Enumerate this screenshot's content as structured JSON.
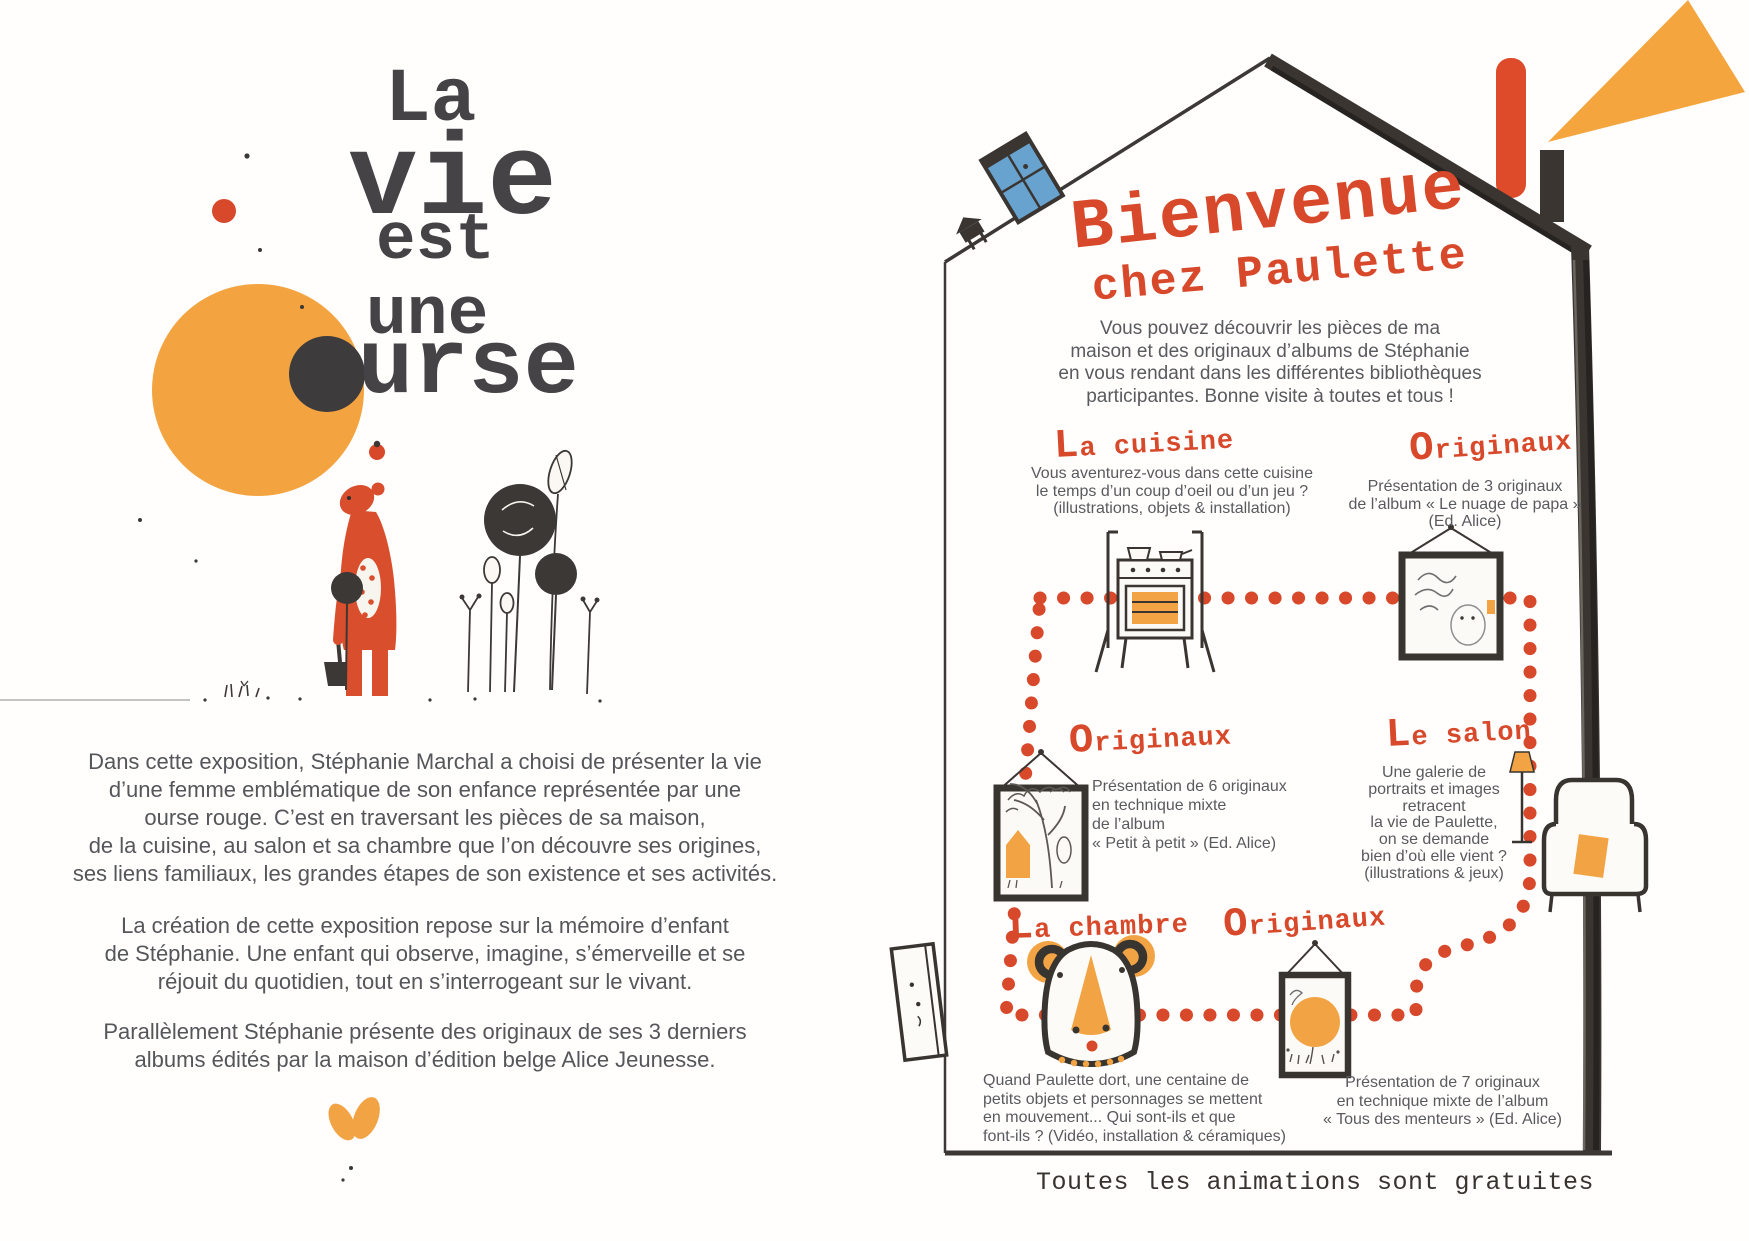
{
  "colors": {
    "accent_red": "#d7492a",
    "accent_orange": "#f2a444",
    "ink": "#3c3835",
    "body_text": "#595a5e",
    "window_blue": "#68a3d0"
  },
  "left_page": {
    "title_la": "La",
    "title_vie": "vie",
    "title_est": "est",
    "title_une": "une",
    "title_ourse_suffix": "urse",
    "paragraph1": [
      "Dans cette exposition, Stéphanie Marchal a choisi de présenter la vie",
      "d’une femme emblématique de son enfance représentée par une",
      "ourse rouge. C’est en traversant les pièces de sa maison,",
      "de la cuisine, au salon et sa chambre que l’on découvre ses origines,",
      "ses liens familiaux, les grandes étapes de son existence et ses activités."
    ],
    "paragraph2": [
      "La création de cette exposition repose sur la mémoire d’enfant",
      "de Stéphanie. Une enfant qui observe, imagine, s’émerveille et se",
      "réjouit du quotidien, tout en s’interrogeant sur le vivant."
    ],
    "paragraph3": [
      "Parallèlement Stéphanie présente des originaux de ses 3 derniers",
      "albums édités par la maison d’édition belge Alice Jeunesse."
    ]
  },
  "right_page": {
    "heading_line1": "Bienvenue",
    "heading_line2": "chez Paulette",
    "intro": [
      "Vous pouvez découvrir les pièces de ma",
      "maison et des originaux d’albums de Stéphanie",
      "en vous rendant dans les différentes bibliothèques",
      "participantes. Bonne visite à toutes et tous !"
    ],
    "sections": {
      "cuisine": {
        "title": "La cuisine",
        "body": [
          "Vous aventurez-vous dans cette cuisine",
          "le temps d’un coup d’oeil ou d’un jeu ?",
          "(illustrations, objets & installation)"
        ]
      },
      "originaux_nuage": {
        "title": "Originaux",
        "body": [
          "Présentation de 3 originaux",
          "de l’album « Le nuage de papa »",
          "(Ed. Alice)"
        ]
      },
      "originaux_petit": {
        "title": "Originaux",
        "body": [
          "Présentation de 6 originaux",
          "en technique mixte",
          "de l’album",
          "« Petit à petit » (Ed. Alice)"
        ]
      },
      "salon": {
        "title": "Le salon",
        "body": [
          "Une galerie de",
          "portraits et images",
          "retracent",
          "la vie de Paulette,",
          "on se demande",
          "bien d’où elle vient ?",
          "(illustrations & jeux)"
        ]
      },
      "chambre": {
        "title": "La chambre",
        "body": [
          "Quand Paulette dort, une centaine de",
          "petits objets et personnages se mettent",
          "en mouvement... Qui sont-ils et que",
          "font-ils ? (Vidéo, installation & céramiques)"
        ]
      },
      "originaux_menteurs": {
        "title": "Originaux",
        "body": [
          "Présentation de 7 originaux",
          "en technique mixte de l’album",
          "« Tous des menteurs » (Ed. Alice)"
        ]
      }
    },
    "footer": "Toutes les animations sont gratuites"
  }
}
